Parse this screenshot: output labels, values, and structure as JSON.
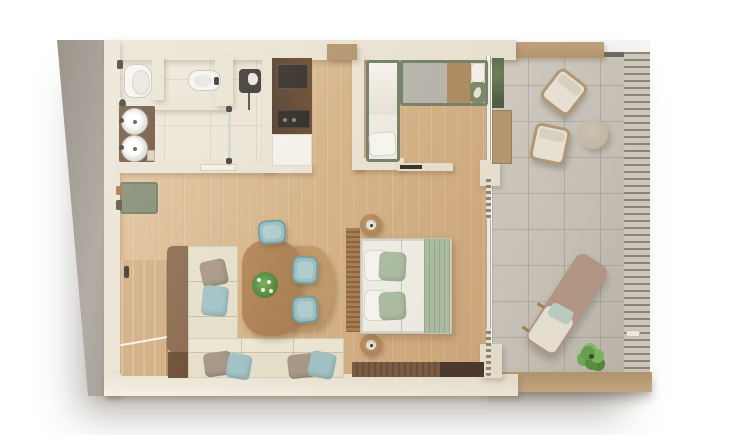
{
  "scene": {
    "type": "floor-plan-render",
    "description": "Top-down 3D rendered floor plan of a suite with bathroom, closet column, kids bedroom, entry hall, living-dining area, master bedroom and terrace",
    "rooms": [
      {
        "name": "bathroom",
        "items": [
          "toilet",
          "toilet-brush",
          "bidet",
          "double-sink-vanity",
          "amenity-tray",
          "shower",
          "shower-glass-door"
        ]
      },
      {
        "name": "closet-column",
        "items": [
          "wardrobe-cabinet",
          "safe",
          "minibar-appliance",
          "white-cabinet"
        ]
      },
      {
        "name": "kids-bedroom",
        "items": [
          "single-bed",
          "daybed",
          "grey-cushion",
          "tan-cushion",
          "white-pillow",
          "green-leaf-pillow",
          "wall-shelf"
        ]
      },
      {
        "name": "entry-hall",
        "items": [
          "entry-door",
          "door-swing",
          "green-bench",
          "luggage-items"
        ]
      },
      {
        "name": "living-dining",
        "items": [
          "corner-sofa",
          "sofa-wood-back",
          "throw-pillows",
          "dining-table",
          "table-extension",
          "plant-centerpiece",
          "dining-chairs"
        ]
      },
      {
        "name": "master-bedroom",
        "items": [
          "double-bed",
          "white-pillows",
          "sage-pillows",
          "sage-throw",
          "slatted-headboard",
          "round-nightstands",
          "table-lamps",
          "media-console",
          "beaded-curtains"
        ]
      },
      {
        "name": "terrace",
        "items": [
          "armchair",
          "armchair",
          "round-pouf",
          "chaise-lounge",
          "chaise-cushion",
          "teal-pillow",
          "potted-plant",
          "hedge-planter",
          "wood-planter",
          "slatted-railing",
          "railing-latch"
        ]
      }
    ]
  },
  "palette": {
    "bg": "#ffffff",
    "wallTop": "#eae3d3",
    "wallSide": "#9a948b",
    "woodFloor": "#d8b68c",
    "tileFloor": "#ece5d5",
    "terraceFloor": "#c9c5bc",
    "terraceWallWood": "#b49872",
    "slat": "#8d877c",
    "vanityWood": "#6b4f38",
    "fixtureWhite": "#f6f4ef",
    "fixtureDark": "#3f3a33",
    "cabinetWood": "#6e5137",
    "cabinetDark": "#38322b",
    "cabinetWhite": "#f4f1ea",
    "bedGreenFrame": "#76846b",
    "beddingWhite": "#f1efe8",
    "sage": "#aebfa4",
    "sageDark": "#93a98c",
    "greyCushion": "#b9b6ae",
    "tanCushion": "#b08d62",
    "benchGreen": "#7e8a6e",
    "doorWood": "#d2ad80",
    "sofaBeige": "#e6dfca",
    "sofaWood": "#8a6a4e",
    "pillowTeal": "#a3c3c6",
    "pillowTaupe": "#a89887",
    "tableWood": "#a87e52",
    "tableExt": "#c09a6b",
    "chairTeal": "#9dbfc2",
    "chairTealDark": "#76a0a3",
    "nightstand": "#a87f55",
    "consoleDark": "#4a372a",
    "chaiseTaupe": "#b49a88",
    "cushionCream": "#ece7da",
    "poufBeige": "#c6bcaa",
    "armchairFrame": "#b49a78"
  }
}
